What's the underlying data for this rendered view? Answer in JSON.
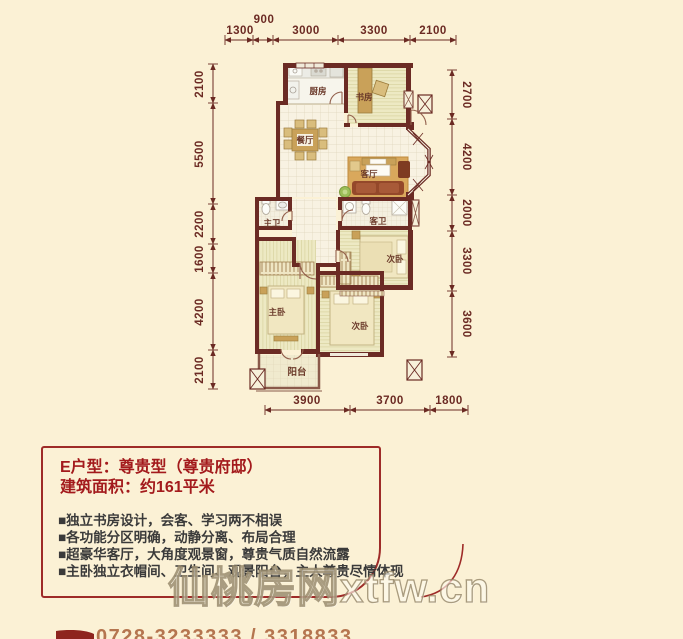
{
  "plan": {
    "rooms": {
      "kitchen": "厨房",
      "study": "书房",
      "dining": "餐厅",
      "living": "客厅",
      "master_bath": "主卫",
      "guest_bath": "客卫",
      "bedroom_right": "次卧",
      "bedroom_bottom": "次卧",
      "master_bedroom": "主卧",
      "balcony": "阳台"
    },
    "dims": {
      "top": [
        "1300",
        "900",
        "3000",
        "3300",
        "2100"
      ],
      "left": [
        "2100",
        "5500",
        "2200",
        "1600",
        "4200",
        "2100"
      ],
      "right": [
        "2700",
        "4200",
        "2000",
        "3300",
        "3600"
      ],
      "bottom": [
        "3900",
        "3700",
        "1800"
      ]
    }
  },
  "info": {
    "title": "E户型：尊贵型（尊贵府邸）",
    "area": "建筑面积：约161平米",
    "features": [
      "■独立书房设计，会客、学习两不相误",
      "■各功能分区明确，动静分离、布局合理",
      "■超豪华客厅，大角度观景窗，尊贵气质自然流露",
      "■主卧独立衣帽间、卫生间、观景阳台，主人尊贵尽情体现"
    ]
  },
  "watermark": {
    "text": "仙桃房网xtfw.cn"
  },
  "footer": {
    "phone": "0728-3233333 / 3318833"
  },
  "colors": {
    "background": "#FBF1D5",
    "wall": "#6B2B24",
    "accent_red": "#9E2B28",
    "dim_text": "#6B2A23",
    "title_red": "#A31A1C",
    "feature_text": "#3A3A3A",
    "phone_brown": "#B5754F",
    "rug_tan": "#D9A85C",
    "sofa_brown": "#94482A",
    "floor_stripe": "#EDE9C3",
    "floor_tile": "#F8F2E2"
  }
}
